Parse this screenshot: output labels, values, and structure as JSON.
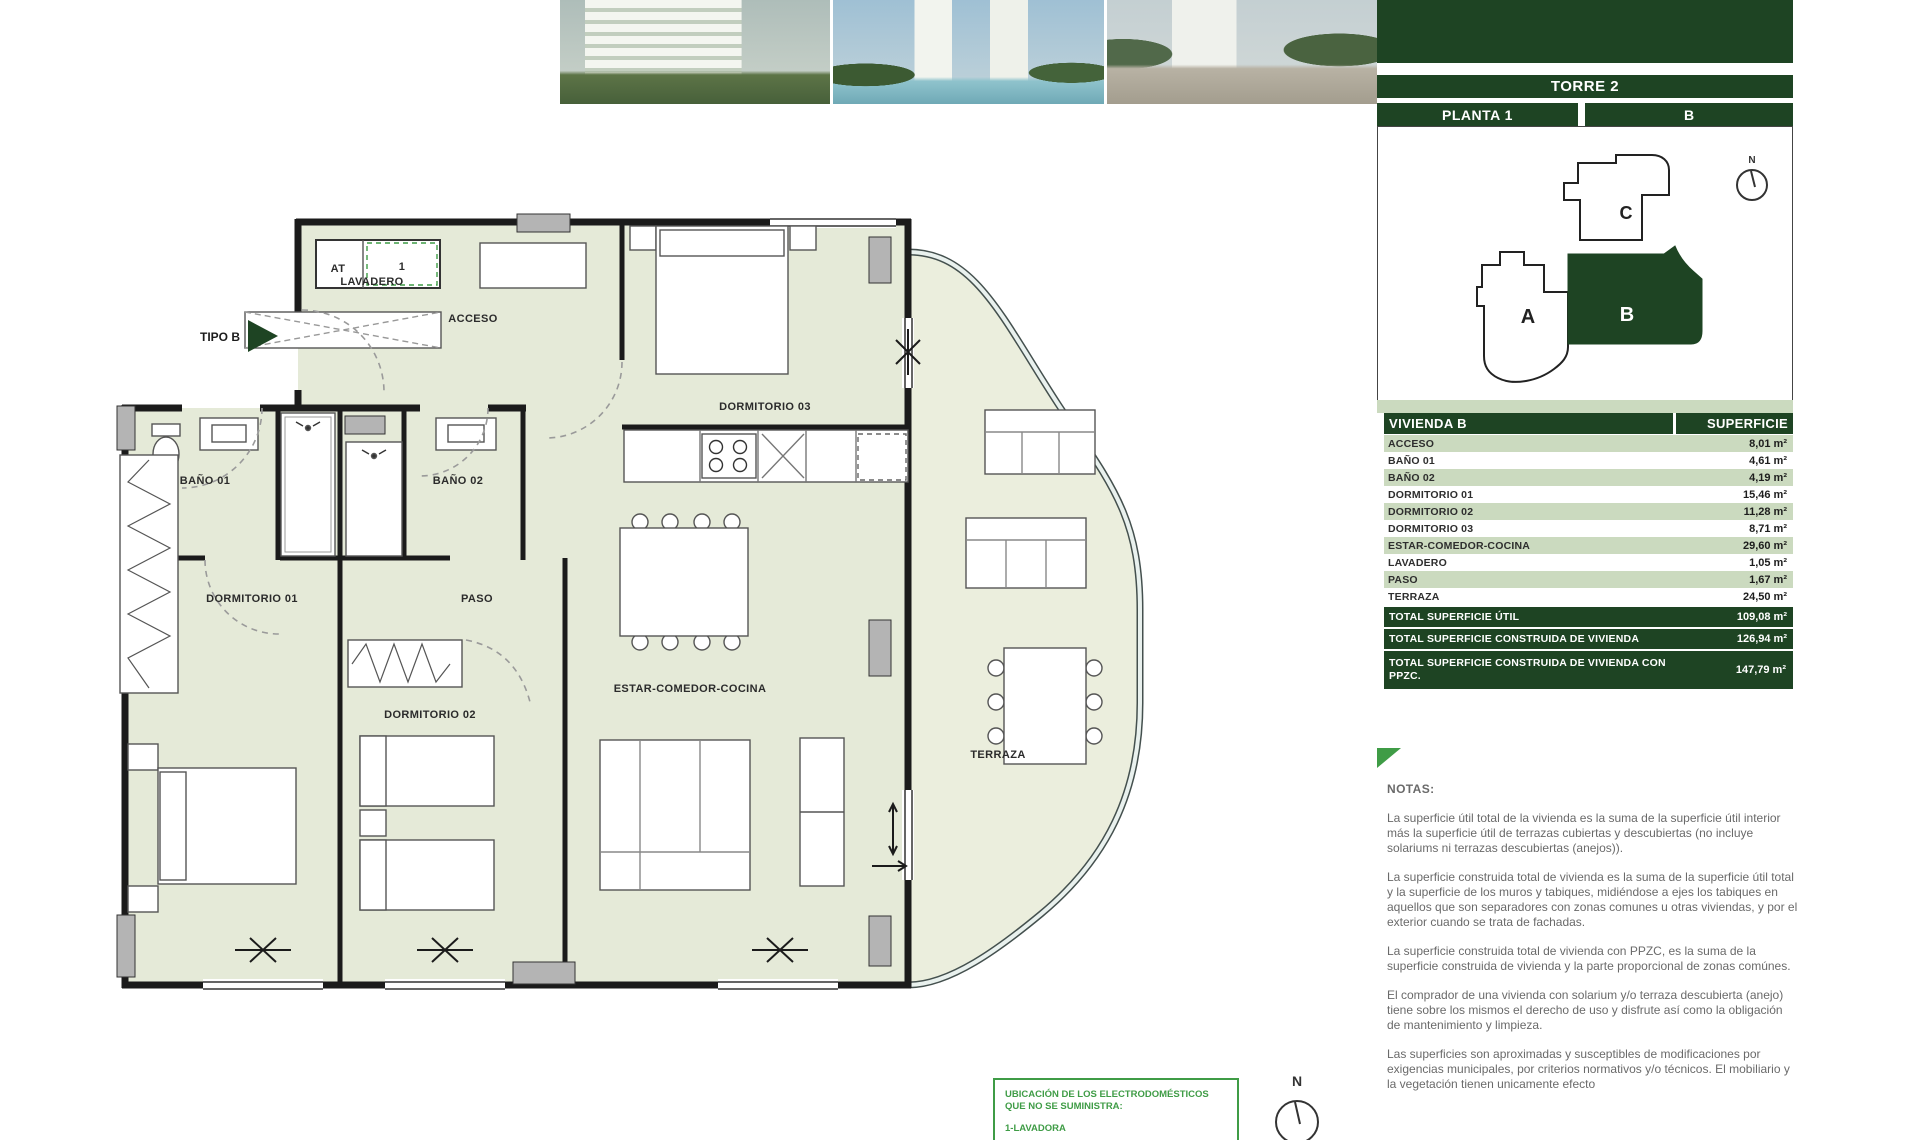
{
  "header": {
    "torre": "TORRE 2",
    "planta": "PLANTA 1",
    "letra": "B"
  },
  "key_plan": {
    "unit_a": "A",
    "unit_b": "B",
    "unit_c": "C",
    "north": "N",
    "highlighted": "B"
  },
  "floorplan": {
    "tipo": "TIPO B",
    "at": "AT",
    "lavadero": "LAVADERO",
    "unit_number": "1",
    "acceso": "ACCESO",
    "bano01": "BAÑO 01",
    "bano02": "BAÑO 02",
    "dorm01": "DORMITORIO 01",
    "dorm02": "DORMITORIO 02",
    "dorm03": "DORMITORIO 03",
    "paso": "PASO",
    "estar": "ESTAR-COMEDOR-COCINA",
    "terraza": "TERRAZA",
    "north": "N"
  },
  "table": {
    "header": {
      "name": "VIVIENDA B",
      "surface": "SUPERFICIE"
    },
    "rows": [
      {
        "label": "ACCESO",
        "value": "8,01 m²"
      },
      {
        "label": "BAÑO 01",
        "value": "4,61 m²"
      },
      {
        "label": "BAÑO 02",
        "value": "4,19 m²"
      },
      {
        "label": "DORMITORIO 01",
        "value": "15,46 m²"
      },
      {
        "label": "DORMITORIO 02",
        "value": "11,28 m²"
      },
      {
        "label": "DORMITORIO 03",
        "value": "8,71 m²"
      },
      {
        "label": "ESTAR-COMEDOR-COCINA",
        "value": "29,60 m²"
      },
      {
        "label": "LAVADERO",
        "value": "1,05 m²"
      },
      {
        "label": "PASO",
        "value": "1,67 m²"
      },
      {
        "label": "TERRAZA",
        "value": "24,50 m²"
      }
    ],
    "totals": [
      {
        "label": "TOTAL SUPERFICIE ÚTIL",
        "value": "109,08 m²"
      },
      {
        "label": "TOTAL SUPERFICIE CONSTRUIDA DE VIVIENDA",
        "value": "126,94 m²"
      },
      {
        "label": "TOTAL SUPERFICIE CONSTRUIDA DE VIVIENDA CON PPZC.",
        "value": "147,79 m²"
      }
    ]
  },
  "notes": {
    "title": "NOTAS:",
    "paragraphs": [
      "La superficie útil total de la vivienda es la suma de la superficie útil interior más la superficie útil de terrazas cubiertas y descubiertas (no incluye solariums ni terrazas descubiertas (anejos)).",
      "La superficie construida total de vivienda es la suma de la superficie útil total y la superficie de los muros y tabiques, midiéndose a ejes los tabiques en aquellos que son separadores con zonas comunes u otras viviendas, y por el exterior cuando se trata de fachadas.",
      "La superficie construida total de vivienda con PPZC, es la suma de la superficie construida de vivienda y la parte proporcional de zonas comúnes.",
      "El comprador de una vivienda con solarium y/o terraza descubierta (anejo) tiene sobre los mismos el derecho de uso y disfrute así como la obligación de mantenimiento y limpieza.",
      "Las superficies son aproximadas y susceptibles de modificaciones por exigencias municipales, por criterios normativos y/o técnicos. El mobiliario y la vegetación tienen unicamente efecto"
    ]
  },
  "appliances_box": {
    "line1": "UBICACIÓN DE LOS ELECTRODOMÉSTICOS QUE NO SE SUMINISTRA:",
    "line2": "1-LAVADORA"
  },
  "colors": {
    "dark_green": "#1e4423",
    "light_green_row": "#cbdabf",
    "floor": "#e5ead8",
    "terrace_floor": "#ebeedd",
    "accent_green": "#3f9c46"
  }
}
